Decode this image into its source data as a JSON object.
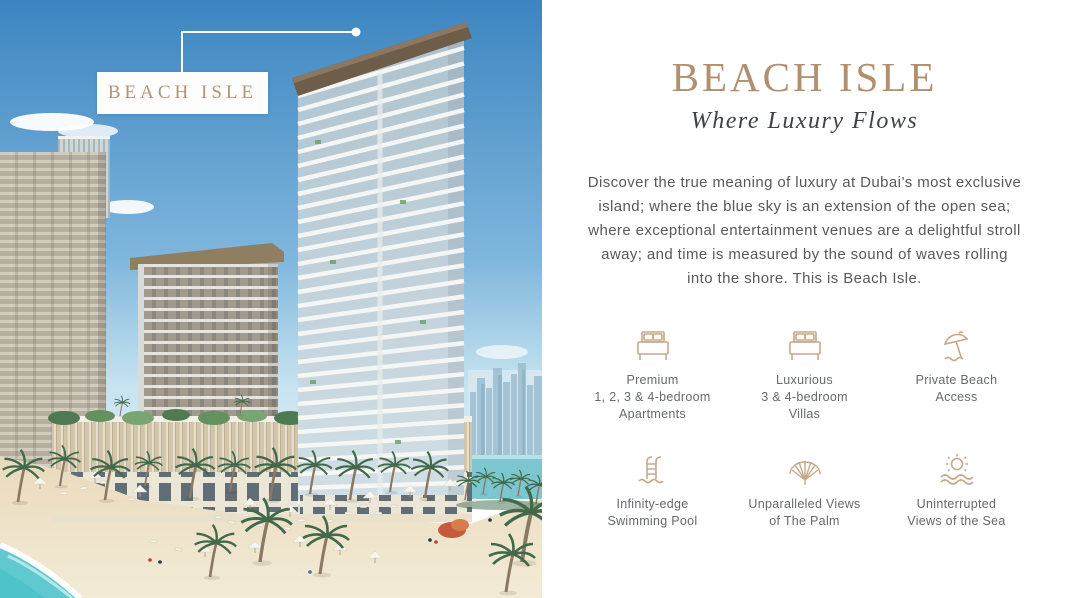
{
  "photo": {
    "callout_label": "BEACH ISLE"
  },
  "panel": {
    "title": "BEACH ISLE",
    "subtitle": "Where Luxury Flows",
    "description": "Discover the true meaning of luxury at Dubai’s most exclusive island; where the blue sky is an extension of the open sea; where exceptional entertainment venues are a delightful stroll away; and time is measured by the sound of waves rolling into the shore. This is Beach Isle.",
    "features": [
      {
        "icon": "bed-icon",
        "lines": [
          "Premium",
          "1, 2, 3 & 4-bedroom",
          "Apartments"
        ]
      },
      {
        "icon": "bed-icon",
        "lines": [
          "Luxurious",
          "3 & 4-bedroom",
          "Villas"
        ]
      },
      {
        "icon": "beach-umbrella-icon",
        "lines": [
          "Private Beach",
          "Access"
        ]
      },
      {
        "icon": "pool-ladder-icon",
        "lines": [
          "Infinity-edge",
          "Swimming Pool"
        ]
      },
      {
        "icon": "palm-island-icon",
        "lines": [
          "Unparalleled Views",
          "of The Palm"
        ]
      },
      {
        "icon": "sun-sea-icon",
        "lines": [
          "Uninterrupted",
          "Views of the Sea"
        ]
      }
    ],
    "colors": {
      "accent": "#b2906f",
      "icon_tan": "#c8a88a",
      "text_body": "#58595b",
      "text_subtitle": "#3f4347",
      "text_feature": "#67696c",
      "label_tan": "#b5947c"
    }
  }
}
